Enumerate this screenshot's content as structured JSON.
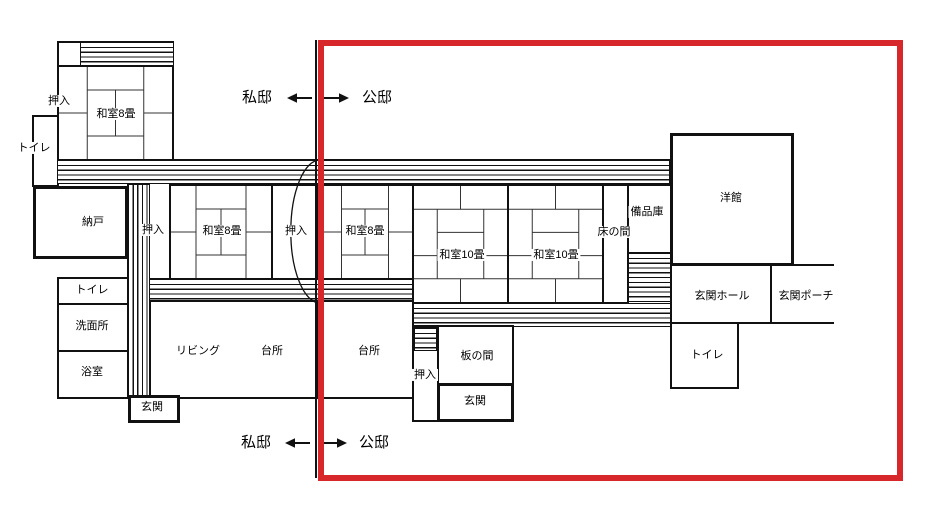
{
  "colors": {
    "wall": "#111111",
    "boundary_frame": "#d7272a"
  },
  "boundary": {
    "top": {
      "private": "私邸",
      "public": "公邸"
    },
    "bottom": {
      "private": "私邸",
      "public": "公邸"
    }
  },
  "rooms": {
    "oshiire_top": "押入",
    "washitsu8_top": "和室8畳",
    "toilet_nw": "トイレ",
    "nando": "納戸",
    "oshiire_1": "押入",
    "washitsu8_1": "和室8畳",
    "oshiire_2": "押入",
    "washitsu8_2": "和室8畳",
    "washitsu10_1": "和室10畳",
    "washitsu10_2": "和室10畳",
    "tokonoma": "床の間",
    "bihinko": "備品庫",
    "yokan": "洋館",
    "genkan_hall": "玄関ホール",
    "genkan_porch": "玄関ポーチ",
    "toilet_e": "トイレ",
    "toilet_w": "トイレ",
    "senmenjo": "洗面所",
    "yokushitsu": "浴室",
    "living": "リビング",
    "kitchen_1": "台所",
    "kitchen_2": "台所",
    "oshiire_3": "押入",
    "itanoma": "板の間",
    "genkan_upper": "玄関",
    "genkan_lower": "玄関"
  }
}
